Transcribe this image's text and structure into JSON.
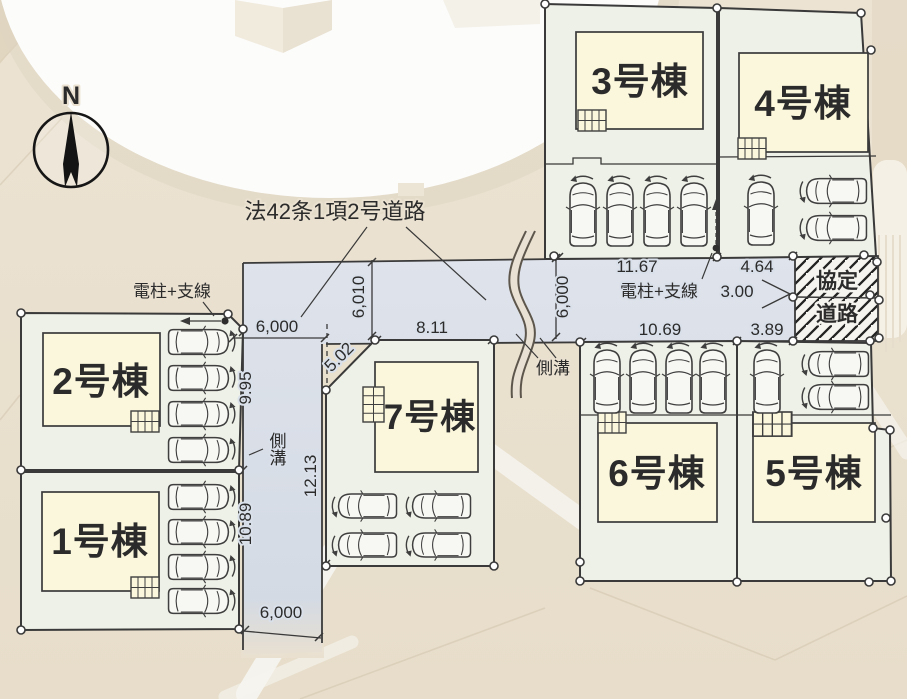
{
  "plan": {
    "north_label": "N",
    "road_label": "法42条1項2号道路",
    "agreement_road": {
      "line1": "協定",
      "line2": "道路"
    },
    "labels": {
      "pole_left": "電柱+支線",
      "pole_right": "電柱+支線",
      "gutter_side": "側溝",
      "gutter_mid": "側溝"
    },
    "lots": [
      {
        "id": "1",
        "label": "1号棟"
      },
      {
        "id": "2",
        "label": "2号棟"
      },
      {
        "id": "3",
        "label": "3号棟"
      },
      {
        "id": "4",
        "label": "4号棟"
      },
      {
        "id": "5",
        "label": "5号棟"
      },
      {
        "id": "6",
        "label": "6号棟"
      },
      {
        "id": "7",
        "label": "7号棟"
      }
    ],
    "dimensions": {
      "road_w_top": "6,000",
      "edge_995": "9.95",
      "edge_1089": "10.89",
      "road_w_bottom": "6,000",
      "edge_1213": "12.13",
      "edge_502": "5.02",
      "road_w_6010": "6,010",
      "front_811": "8.11",
      "road_w_right": "6,000",
      "front_1167": "11.67",
      "front_464": "4.64",
      "agreement_w": "3.00",
      "front_1069": "10.69",
      "front_389": "3.89"
    },
    "colors": {
      "lot_fill": "#eef1e7",
      "building_fill": "#fbf7dc",
      "road_fill": "#d9dfe8",
      "line": "#3a3a3a",
      "floor": "#e9e0d0"
    }
  }
}
